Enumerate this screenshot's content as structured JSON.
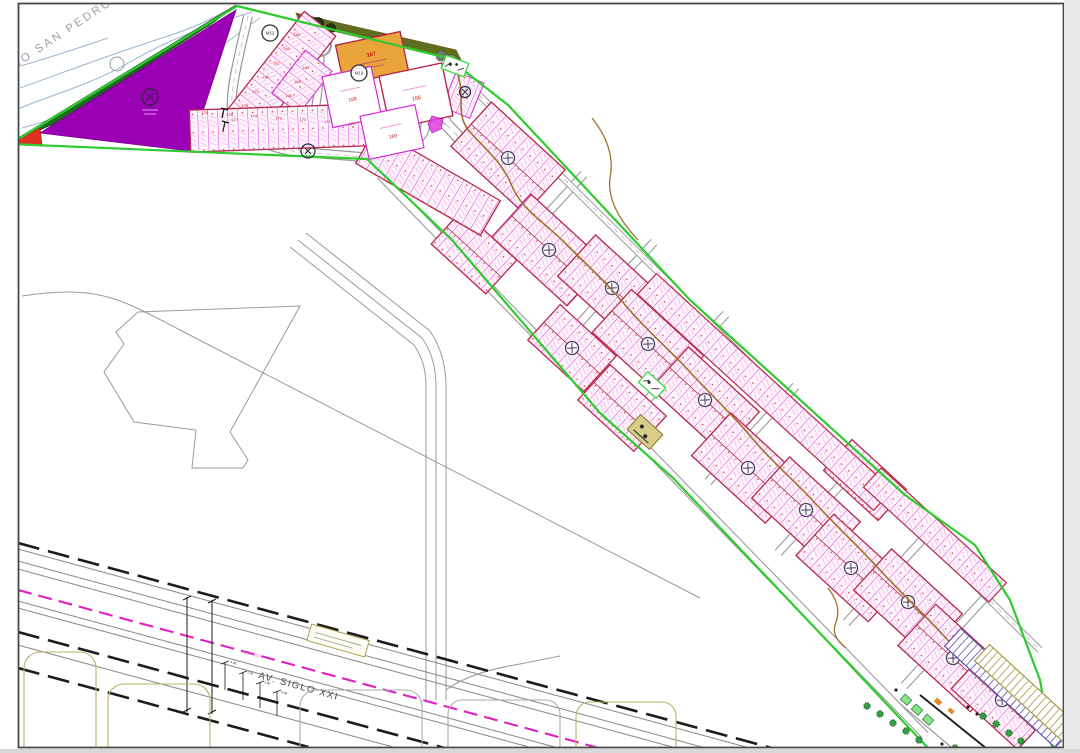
{
  "plan": {
    "river_label": "RIO SAN PEDRO",
    "avenue_label": "AV. SIGLO XXI",
    "gas_line_label": "GAS NAT.",
    "orange_lot_number": "167",
    "big_lot_a": "166",
    "big_lot_b": "168",
    "big_lot_c": "169",
    "row_lot_numbers": [
      "176",
      "175",
      "174",
      "173",
      "172",
      "171",
      "170"
    ],
    "column_lot_numbers": [
      "183",
      "182",
      "181",
      "180",
      "179",
      "178",
      "177"
    ],
    "wedge_lot_numbers": [
      "184",
      "185",
      "186"
    ],
    "top_block_markers": [
      "M12",
      "M19"
    ],
    "dimension_texts": [
      "4.00",
      "1.50",
      "1.00",
      "3.00"
    ],
    "colors": {
      "boundary_green": "#2ecc2e",
      "lot_line_magenta": "#d429d4",
      "block_border": "#b5294a",
      "reserve_purple": "#9b00b4",
      "woodland_green": "#1d6b21",
      "olive_strip": "#7d9a3c",
      "alert_red": "#e03020",
      "commercial_orange": "#eaa43c",
      "gas_magenta": "#e020c0",
      "contour_brown": "#a5702e"
    }
  }
}
